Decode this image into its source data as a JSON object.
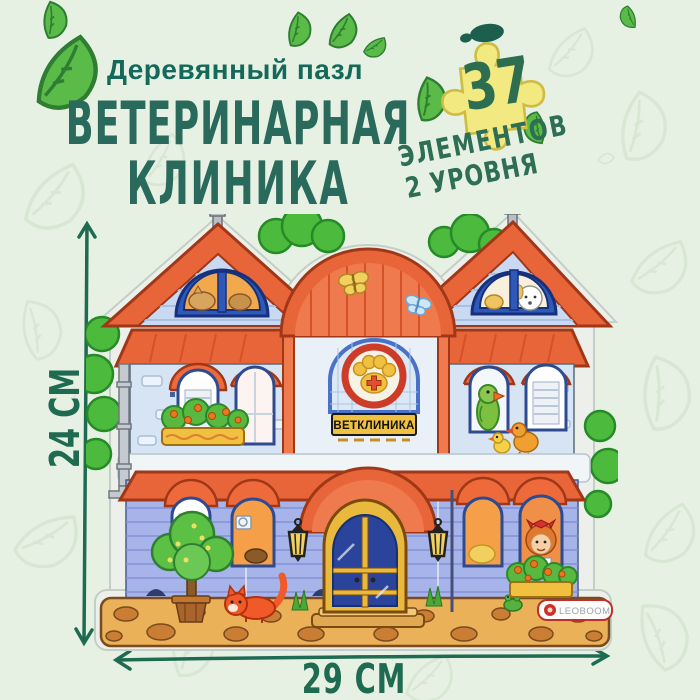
{
  "header": {
    "subtitle": "Деревянный пазл",
    "title_line1": "ВЕТЕРИНАРНАЯ",
    "title_line2": "КЛИНИКА"
  },
  "badge": {
    "count": "37",
    "label_line1": "ЭЛЕМЕНТОВ",
    "label_line2": "2 УРОВНЯ"
  },
  "dimensions": {
    "height": "24 СМ",
    "width": "29 СМ"
  },
  "house": {
    "sign_text": "ВЕТКЛИНИКА",
    "brand_text": "LEOBOOM"
  },
  "colors": {
    "background": "#e7f1e3",
    "subtitle_green": "#15695a",
    "title_green": "#2a6a5c",
    "arrow_green": "#1e6b52",
    "leaf_green": "#5bbb49",
    "puzzle_yellow": "#f2e981",
    "roof_orange": "#e8653a",
    "upper_wall_blue": "#d6e4f4",
    "lower_wall_lavender": "#a7b4ea",
    "door_yellow": "#e9b93e",
    "sign_yellow": "#f0c040",
    "foundation_tan": "#eab158"
  }
}
